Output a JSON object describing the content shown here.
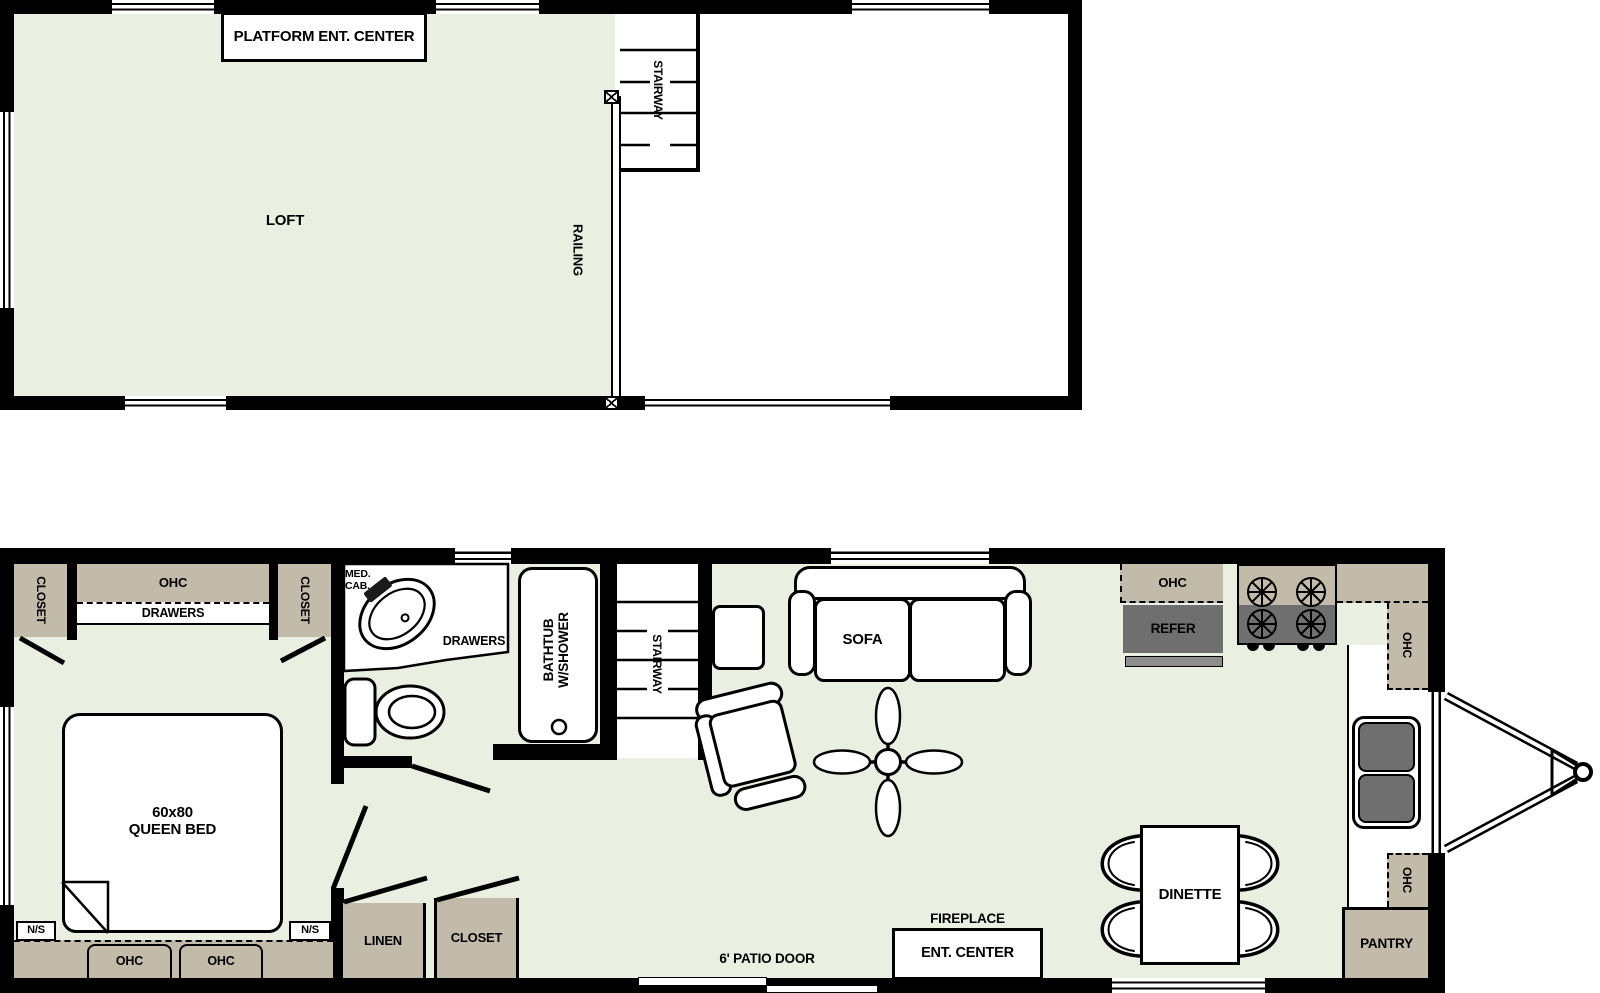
{
  "colors": {
    "floor": "#e9f0e1",
    "cabinet": "#c3bbaa",
    "appliance": "#6f6f6f",
    "appliance_light": "#8d8d8d",
    "wall": "#000000"
  },
  "upper_floor": {
    "platform_ent_center": "PLATFORM ENT. CENTER",
    "loft": "LOFT",
    "stairway": "STAIRWAY",
    "railing": "RAILING"
  },
  "main_floor": {
    "bedroom": {
      "closet_left": "CLOSET",
      "closet_right": "CLOSET",
      "ohc": "OHC",
      "drawers": "DRAWERS",
      "bed_line1": "60x80",
      "bed_line2": "QUEEN BED",
      "ns_left": "N/S",
      "ns_right": "N/S",
      "ohc_base_left": "OHC",
      "ohc_base_right": "OHC"
    },
    "bathroom": {
      "med_cab_line1": "MED.",
      "med_cab_line2": "CAB.",
      "drawers": "DRAWERS",
      "bathtub_line1": "BATHTUB",
      "bathtub_line2": "W/SHOWER"
    },
    "stairway": "STAIRWAY",
    "hall": {
      "linen": "LINEN",
      "closet": "CLOSET"
    },
    "living": {
      "sofa": "SOFA",
      "fireplace": "FIREPLACE",
      "ent_center": "ENT. CENTER",
      "patio_door": "6' PATIO DOOR"
    },
    "kitchen": {
      "ohc_refer": "OHC",
      "refer": "REFER",
      "ohc_corner": "OHC",
      "ohc_counter": "OHC",
      "pantry": "PANTRY"
    },
    "dinette": "DINETTE"
  }
}
